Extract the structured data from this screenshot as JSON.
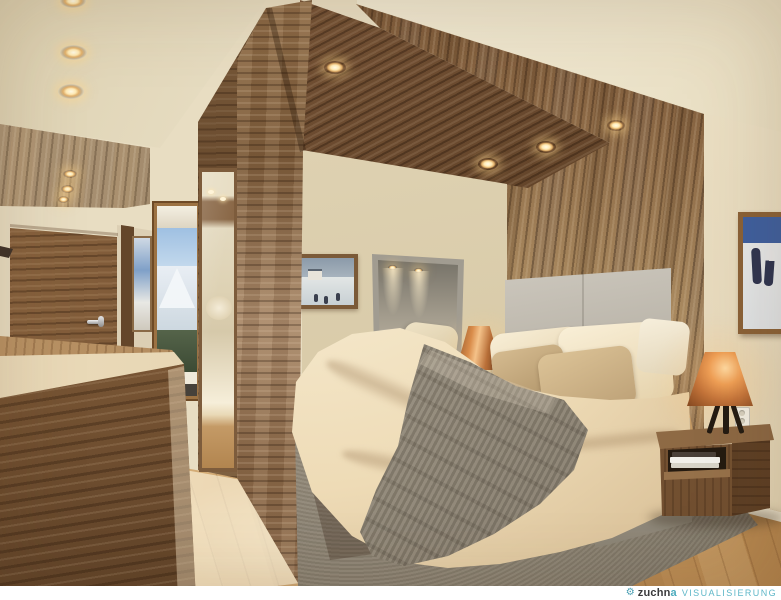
{
  "watermark": {
    "logo_icon": "gear-icon",
    "brand_main": "zuchn",
    "brand_accent": "a",
    "company_type": "VISUALISIERUNG",
    "text_full": "zuchna VISUALISIERUNG",
    "colors": {
      "brand": "#3a3a3c",
      "accent": "#4aabbd"
    }
  },
  "palette": {
    "wall_cream": "#e8ddc2",
    "ceiling_cream": "#f1e9d4",
    "wood_light": "#a9895f",
    "wood_mid": "#8a6744",
    "wood_dark": "#5e4026",
    "floor_oak": "#cda26b",
    "bedding_cream": "#f3e6c8",
    "throw_taupe": "#938a7a",
    "headboard_grey": "#b8b2a6",
    "copper_lamp": "#c4743a",
    "rug_grey": "#8b8272",
    "spotlight_warm": "#ffeab4"
  }
}
